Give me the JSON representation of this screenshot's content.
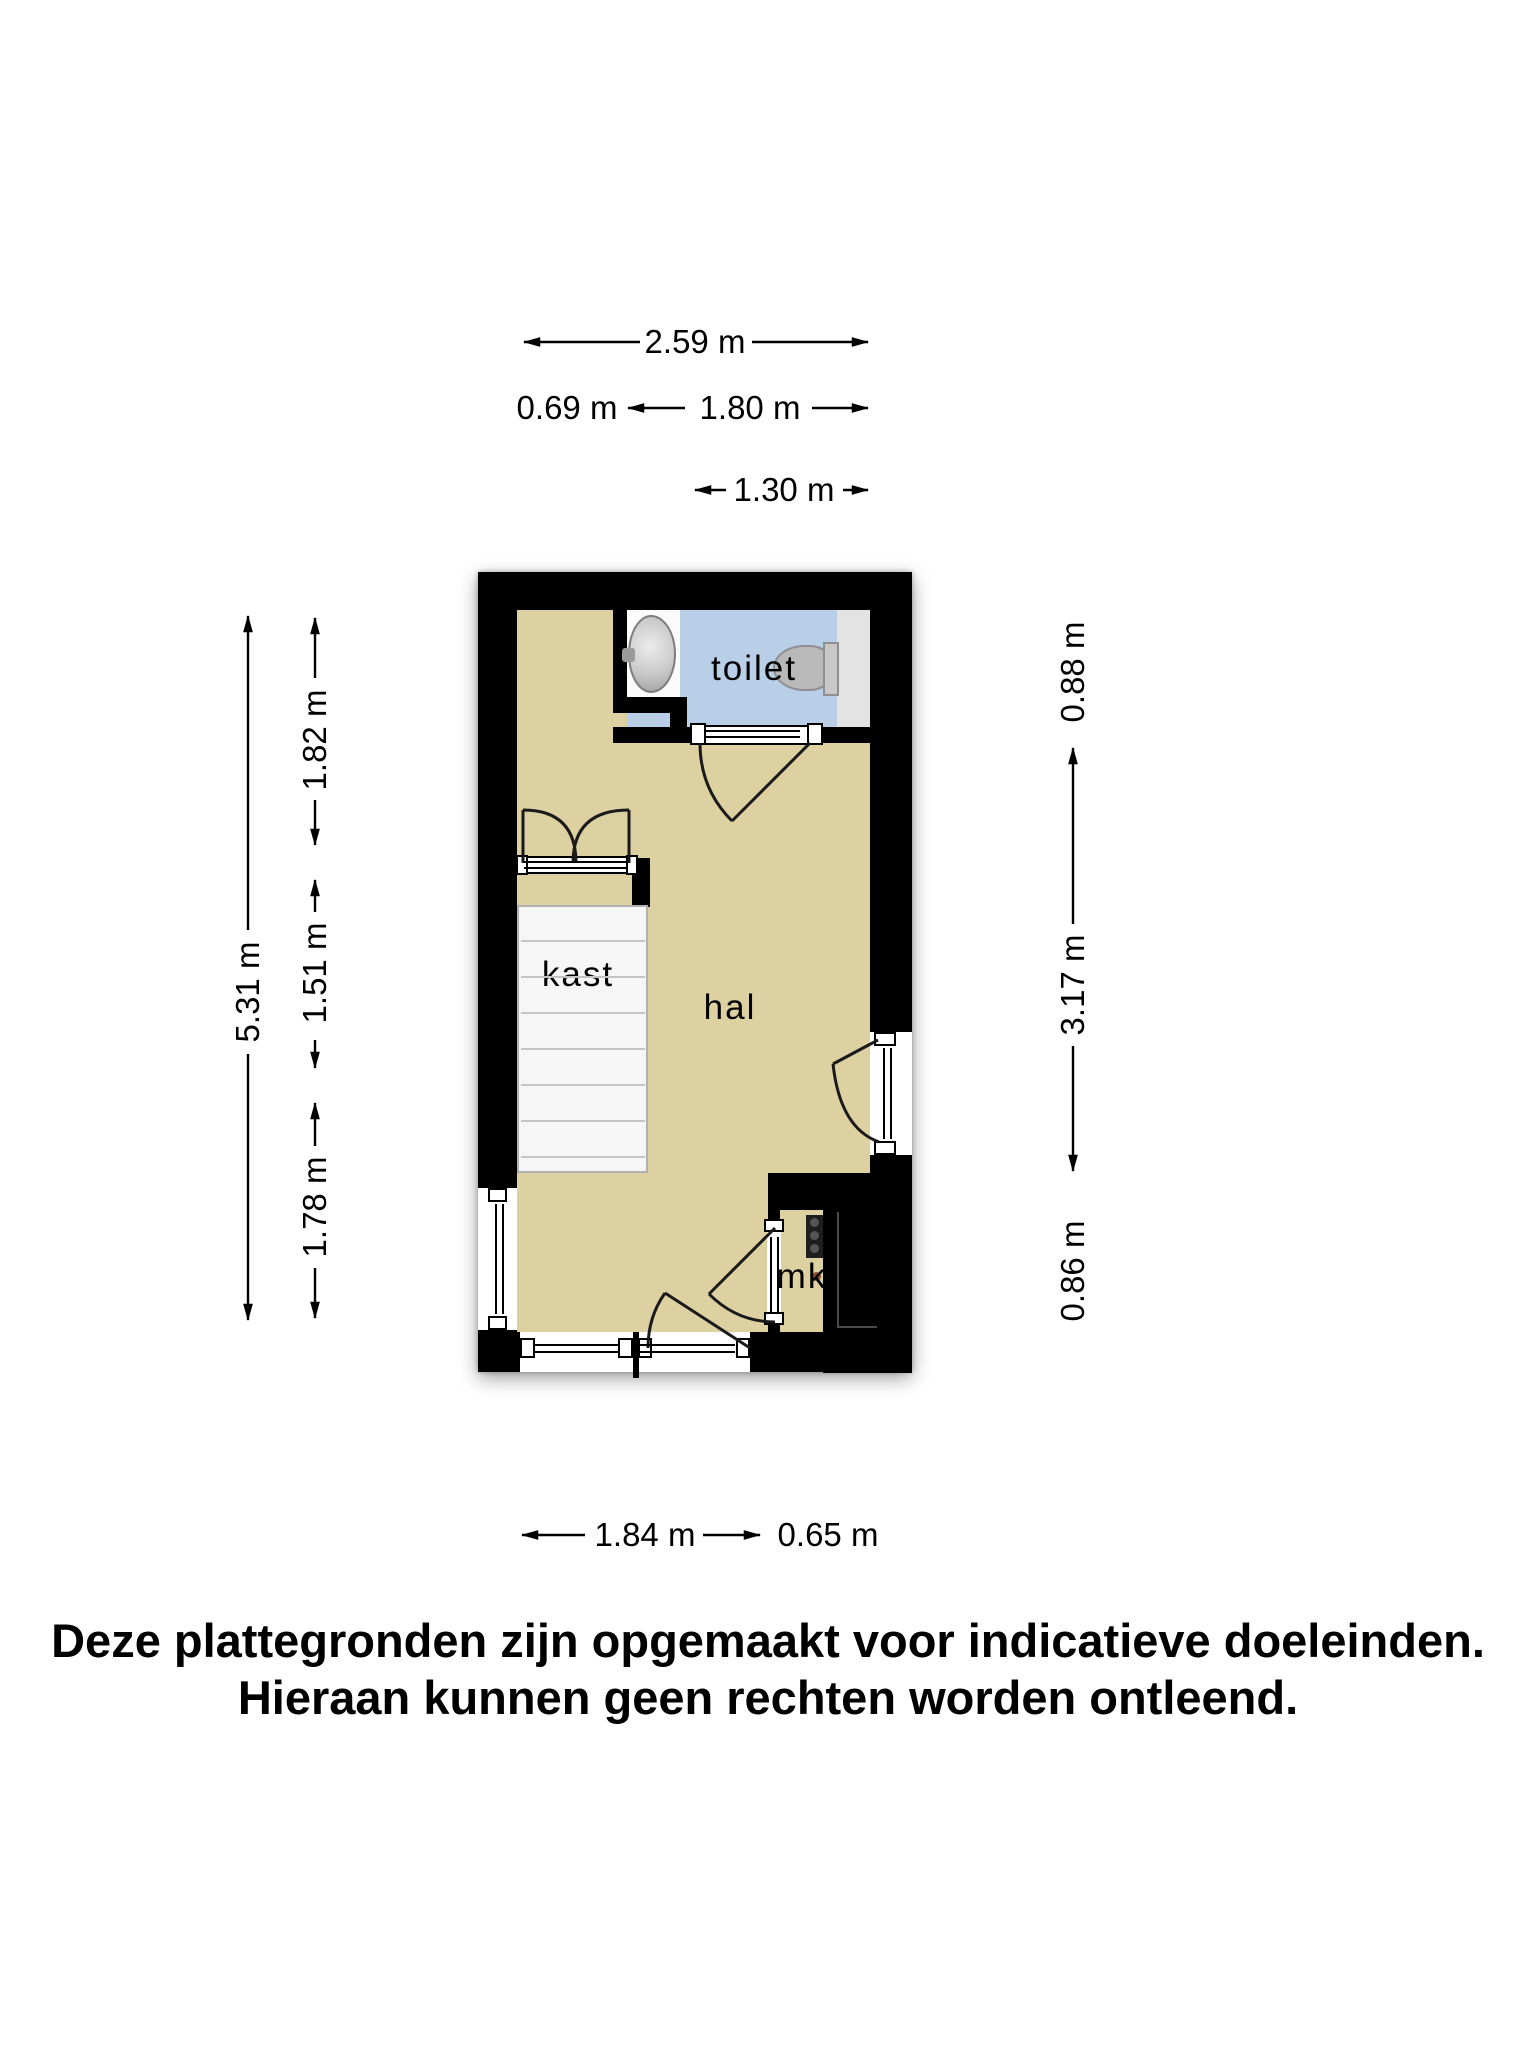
{
  "plan": {
    "rooms": [
      {
        "id": "toilet",
        "label": "toilet"
      },
      {
        "id": "kast",
        "label": "kast"
      },
      {
        "id": "hal",
        "label": "hal"
      },
      {
        "id": "mk",
        "label": "mk"
      }
    ]
  },
  "dimensions": {
    "top_total": "2.59 m",
    "top_left": "0.69 m",
    "top_right": "1.80 m",
    "top_toilet": "1.30 m",
    "left_total": "5.31 m",
    "left_upper": "1.82 m",
    "left_middle": "1.51 m",
    "left_lower": "1.78 m",
    "right_toilet": "0.88 m",
    "right_hal": "3.17 m",
    "right_mk": "0.86 m",
    "bottom_hal": "1.84 m",
    "bottom_mk": "0.65 m"
  },
  "disclaimer": {
    "line1": "Deze plattegronden zijn opgemaakt voor indicatieve doeleinden.",
    "line2": "Hieraan kunnen geen rechten worden ontleend."
  },
  "colors": {
    "wall": "#000000",
    "floor": "#ddd0a1",
    "toilet_floor": "#b9cfe8",
    "shaft": "#e3e3e3",
    "stairs": "#f6f6f6",
    "fixture": "#b9b9b9",
    "text": "#000000"
  }
}
